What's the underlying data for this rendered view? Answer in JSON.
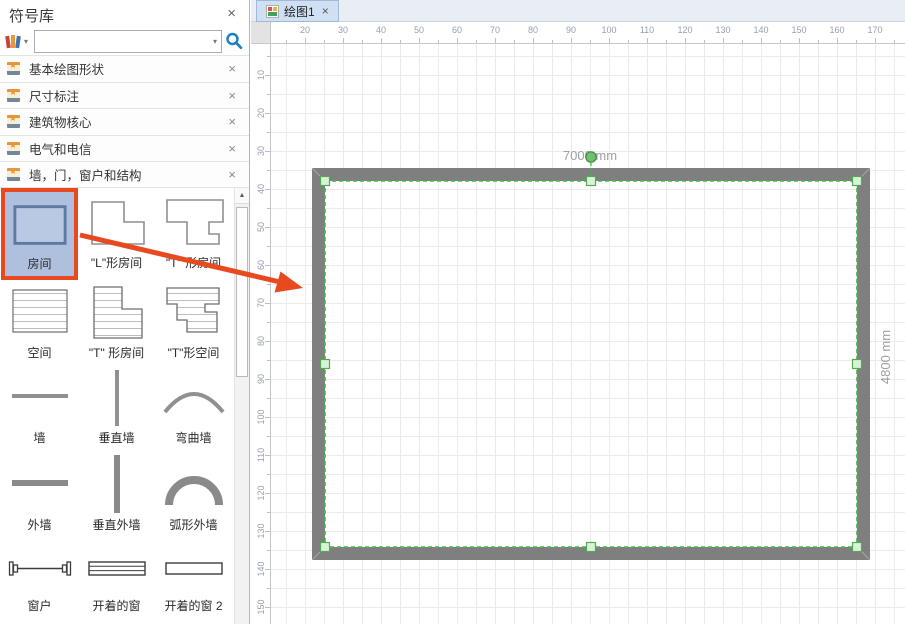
{
  "ui": {
    "close_glyph": "×",
    "caret_glyph": "▾",
    "scroll_up_glyph": "▲"
  },
  "panel": {
    "title": "符号库",
    "search_placeholder": "",
    "sections": [
      "基本绘图形状",
      "尺寸标注",
      "建筑物核心",
      "电气和电信",
      "墙，门，窗户和结构"
    ],
    "shapes": [
      "房间",
      "\"L\"形房间",
      "\"T\" 形房间",
      "空间",
      "\"T\" 形房间",
      "\"T\"形空间",
      "墙",
      "垂直墙",
      "弯曲墙",
      "外墙",
      "垂直外墙",
      "弧形外墙",
      "窗户",
      "开着的窗",
      "开着的窗 2"
    ]
  },
  "tabs": {
    "active": "绘图1"
  },
  "rulers": {
    "horizontal": [
      20,
      30,
      40,
      50,
      60,
      70,
      80,
      90,
      100,
      110,
      120,
      130,
      140,
      150,
      160,
      170
    ],
    "vertical": [
      10,
      20,
      30,
      40,
      50,
      60,
      70,
      80,
      90,
      100,
      110,
      120,
      130,
      140,
      150
    ]
  },
  "drawing": {
    "width_label": "7000 mm",
    "height_label": "4800 mm"
  },
  "colors": {
    "accent_orange": "#e8491f",
    "selection_green": "#3dbb3d",
    "wall_gray": "#7f7f7f",
    "search_blue": "#1b7fc4",
    "selected_cell_bg": "#aec0de"
  }
}
